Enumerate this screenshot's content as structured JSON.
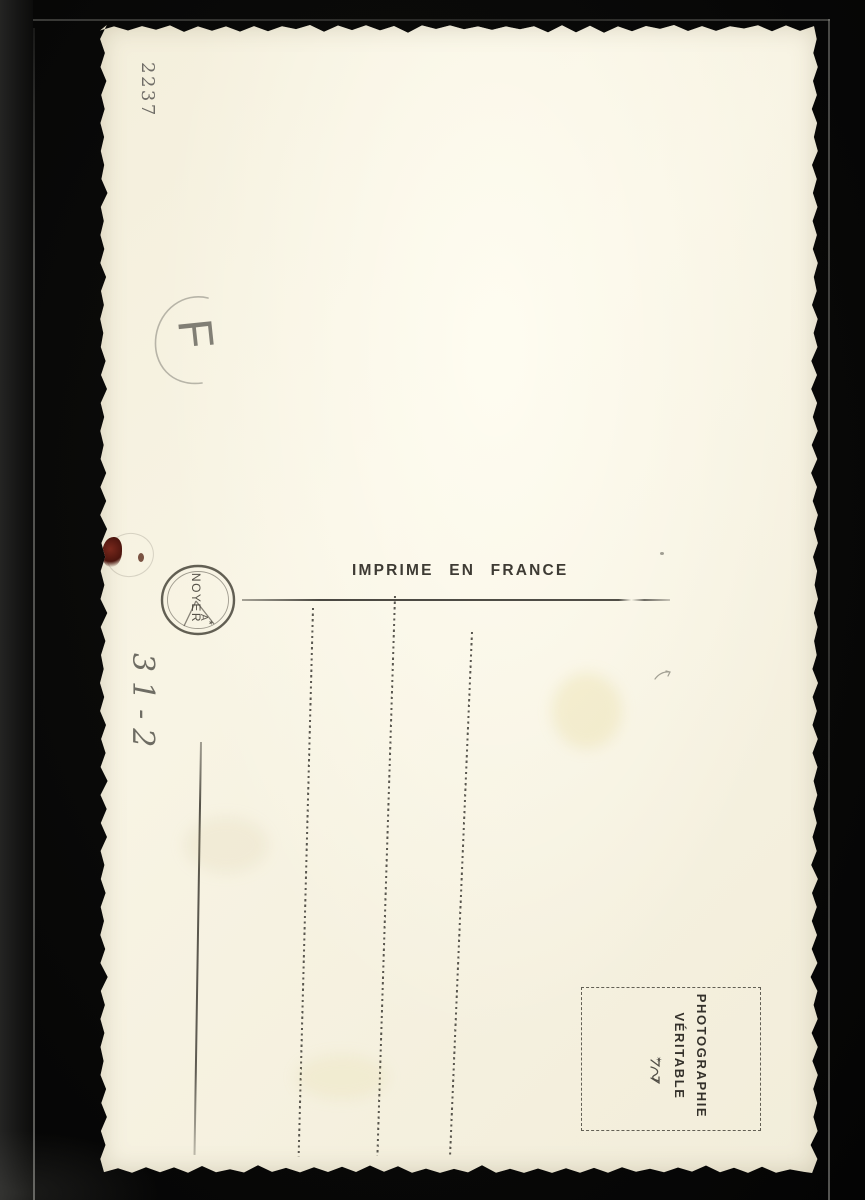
{
  "photo": {
    "description_colors": {
      "backdrop": "#0a0a09",
      "card_paper": "#f6f1df",
      "printed_ink": "#3b3833",
      "pencil": "#6e6c64",
      "stain": "#5a1d12"
    }
  },
  "card": {
    "corner_number": "2237",
    "pencil_circled_letter": "F",
    "pencil_note": "31-2",
    "imprint": "IMPRIME EN FRANCE",
    "publisher_stamp": {
      "name": "NOYER",
      "initial": "A",
      "star": "★"
    },
    "stamp_box": {
      "line1": "PHOTOGRAPHIE",
      "line2": "VÉRITABLE",
      "star": "✶"
    }
  }
}
